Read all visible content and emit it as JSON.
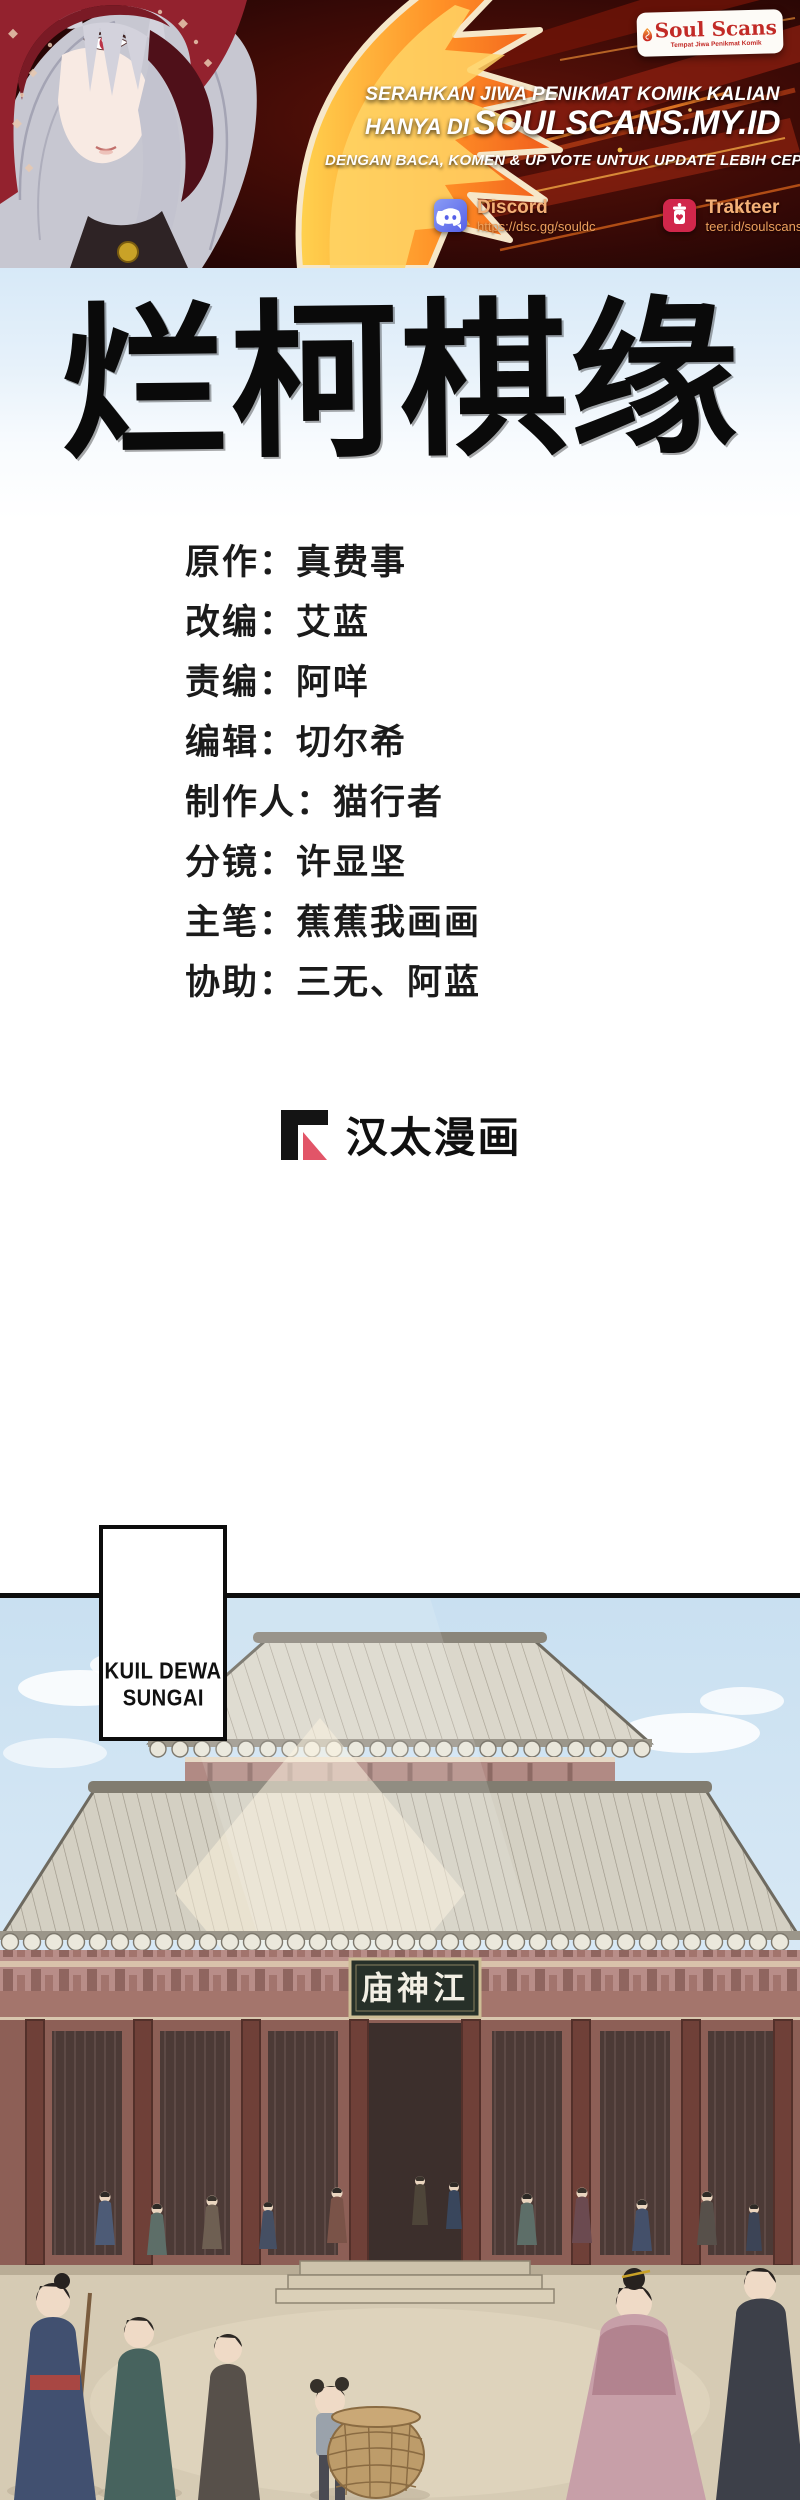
{
  "banner": {
    "logo": {
      "name": "Soul Scans",
      "tagline": "Tempat Jiwa Penikmat Komik"
    },
    "headline": "SERAHKAN JIWA PENIKMAT KOMIK KALIAN",
    "subline_prefix": "HANYA DI",
    "site": "SOULSCANS.MY.ID",
    "note": "DENGAN BACA, KOMEN & UP VOTE UNTUK UPDATE LEBIH CEPAT",
    "links": [
      {
        "name": "Discord",
        "url": "https://dsc.gg/souldc"
      },
      {
        "name": "Trakteer",
        "url": "teer.id/soulscans"
      }
    ],
    "colors": {
      "discord_icon": "#5865f2",
      "trakteer_icon": "#d1274b",
      "link_text": "#f4b178",
      "logo_red": "#c22a26",
      "flame_orange": "#ff8a1e"
    }
  },
  "title": {
    "calligraphy": "烂柯棋缘"
  },
  "credits": {
    "colon": "：",
    "rows": [
      {
        "role": "原作",
        "name": "真费事"
      },
      {
        "role": "改编",
        "name": "艾蓝"
      },
      {
        "role": "责编",
        "name": "阿咩"
      },
      {
        "role": "编辑",
        "name": "切尔希"
      },
      {
        "role": "制作人",
        "name": "猫行者"
      },
      {
        "role": "分镜",
        "name": "许显坚"
      },
      {
        "role": "主笔",
        "name": "蕉蕉我画画"
      },
      {
        "role": "协助",
        "name": "三无、阿蓝"
      }
    ]
  },
  "publisher": {
    "name": "汉太漫画",
    "mark_red": "#e25568"
  },
  "panel": {
    "caption_line1": "KUIL DEWA",
    "caption_line2": "SUNGAI",
    "temple_sign": "庙神江"
  }
}
